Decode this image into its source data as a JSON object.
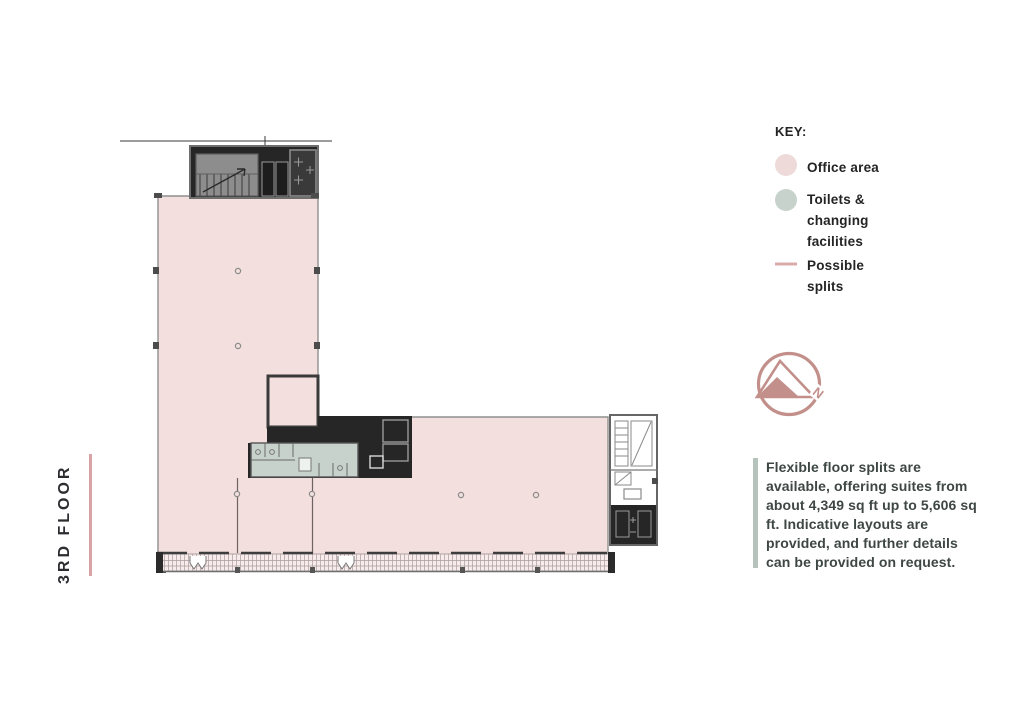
{
  "floor_label": "3RD FLOOR",
  "key": {
    "heading": "KEY:",
    "items": [
      {
        "id": "office-area",
        "label": "Office area",
        "swatch": "circle",
        "color": "#efdada"
      },
      {
        "id": "toilets-changing",
        "label": "Toilets &\nchanging\nfacilities",
        "swatch": "circle",
        "color": "#c6d2cb"
      },
      {
        "id": "possible-splits",
        "label": "Possible\nsplits",
        "swatch": "line",
        "color": "#d9abab"
      }
    ]
  },
  "compass": {
    "north_label": "N",
    "color": "#c38f8a"
  },
  "note": {
    "text": "Flexible floor splits are available, offering suites from about 4,349 sq ft up to 5,606 sq ft. Indicative layouts are provided, and further details can be provided on request.",
    "accent_color": "#b5c3bc"
  },
  "floorplan": {
    "floor_name": "3rd floor plan",
    "office_area_color": "#f3dfde",
    "toilets_color": "#c6d2cb",
    "core_color": "#262626",
    "wall_color": "#707070",
    "split_line_color": "#6e6262"
  }
}
